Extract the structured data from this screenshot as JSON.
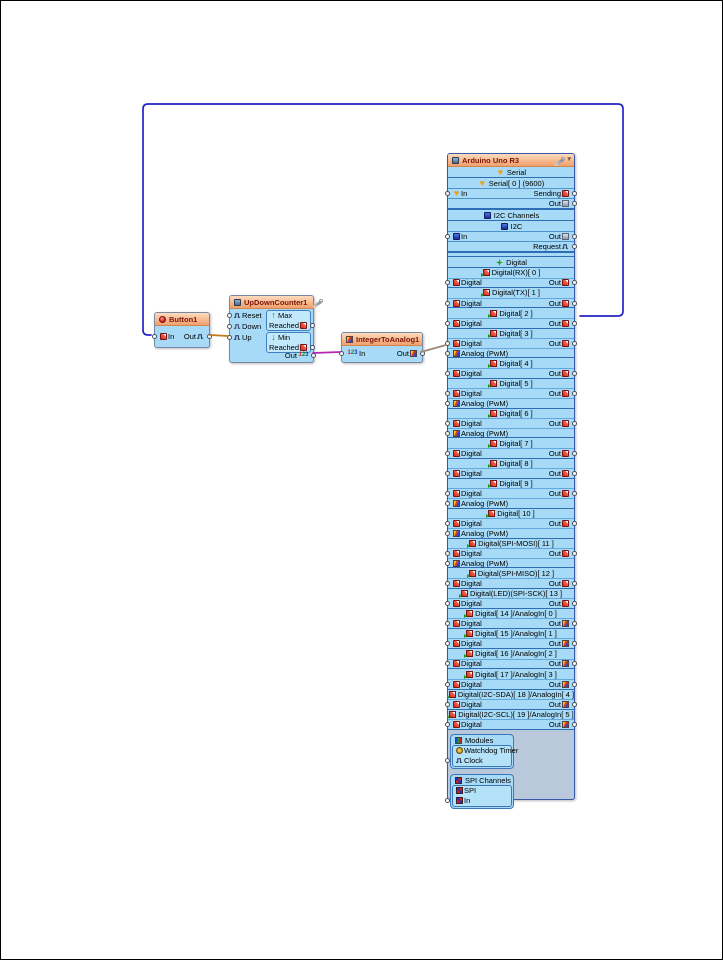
{
  "wires": {
    "feedback": "#2424c8",
    "button_to_counter": "#c07818",
    "counter_to_converter": "#b028b0",
    "converter_to_arduino": "#9a8878"
  },
  "components": {
    "button1": {
      "title": "Button1",
      "in_label": "In",
      "out_label": "Out"
    },
    "updowncounter1": {
      "title": "UpDownCounter1",
      "reset_label": "Reset",
      "down_label": "Down",
      "up_label": "Up",
      "max_label": "Max",
      "min_label": "Min",
      "reached_label": "Reached",
      "out_label": "Out"
    },
    "integertoanalog1": {
      "title": "IntegerToAnalog1",
      "in_label": "In",
      "out_label": "Out"
    },
    "arduino": {
      "title": "Arduino Uno R3",
      "serial_group": "Serial",
      "serial_channel": "Serial[ 0 ] (9600)",
      "serial_in": "In",
      "serial_sending": "Sending",
      "serial_out": "Out",
      "i2c_group": "I2C Channels",
      "i2c_channel": "I2C",
      "i2c_in": "In",
      "i2c_out": "Out",
      "i2c_request": "Request",
      "digital_group": "Digital",
      "digital_in_label": "Digital",
      "digital_out_label": "Out",
      "pwm_label": "Analog (PwM)",
      "digital_pins": [
        {
          "label": "Digital(RX)[ 0 ]",
          "pwm": false,
          "analog_out": false
        },
        {
          "label": "Digital(TX)[ 1 ]",
          "pwm": false,
          "analog_out": false
        },
        {
          "label": "Digital[ 2 ]",
          "pwm": false,
          "analog_out": false
        },
        {
          "label": "Digital[ 3 ]",
          "pwm": true,
          "analog_out": false
        },
        {
          "label": "Digital[ 4 ]",
          "pwm": false,
          "analog_out": false
        },
        {
          "label": "Digital[ 5 ]",
          "pwm": true,
          "analog_out": false
        },
        {
          "label": "Digital[ 6 ]",
          "pwm": true,
          "analog_out": false
        },
        {
          "label": "Digital[ 7 ]",
          "pwm": false,
          "analog_out": false
        },
        {
          "label": "Digital[ 8 ]",
          "pwm": false,
          "analog_out": false
        },
        {
          "label": "Digital[ 9 ]",
          "pwm": true,
          "analog_out": false
        },
        {
          "label": "Digital[ 10 ]",
          "pwm": true,
          "analog_out": false
        },
        {
          "label": "Digital(SPI-MOSI)[ 11 ]",
          "pwm": true,
          "analog_out": false
        },
        {
          "label": "Digital(SPI-MISO)[ 12 ]",
          "pwm": false,
          "analog_out": false
        },
        {
          "label": "Digital(LED)(SPI-SCK)[ 13 ]",
          "pwm": false,
          "analog_out": false
        },
        {
          "label": "Digital[ 14 ]/AnalogIn[ 0 ]",
          "pwm": false,
          "analog_out": true
        },
        {
          "label": "Digital[ 15 ]/AnalogIn[ 1 ]",
          "pwm": false,
          "analog_out": true
        },
        {
          "label": "Digital[ 16 ]/AnalogIn[ 2 ]",
          "pwm": false,
          "analog_out": true
        },
        {
          "label": "Digital[ 17 ]/AnalogIn[ 3 ]",
          "pwm": false,
          "analog_out": true
        },
        {
          "label": "Digital(I2C-SDA)[ 18 ]/AnalogIn[ 4 ]",
          "pwm": false,
          "analog_out": true
        },
        {
          "label": "Digital(I2C-SCL)[ 19 ]/AnalogIn[ 5 ]",
          "pwm": false,
          "analog_out": true
        }
      ],
      "modules_group": "Modules",
      "watchdog_label": "Watchdog Timer",
      "clock_label": "Clock",
      "spi_group": "SPI Channels",
      "spi_channel": "SPI",
      "spi_in": "In"
    }
  }
}
